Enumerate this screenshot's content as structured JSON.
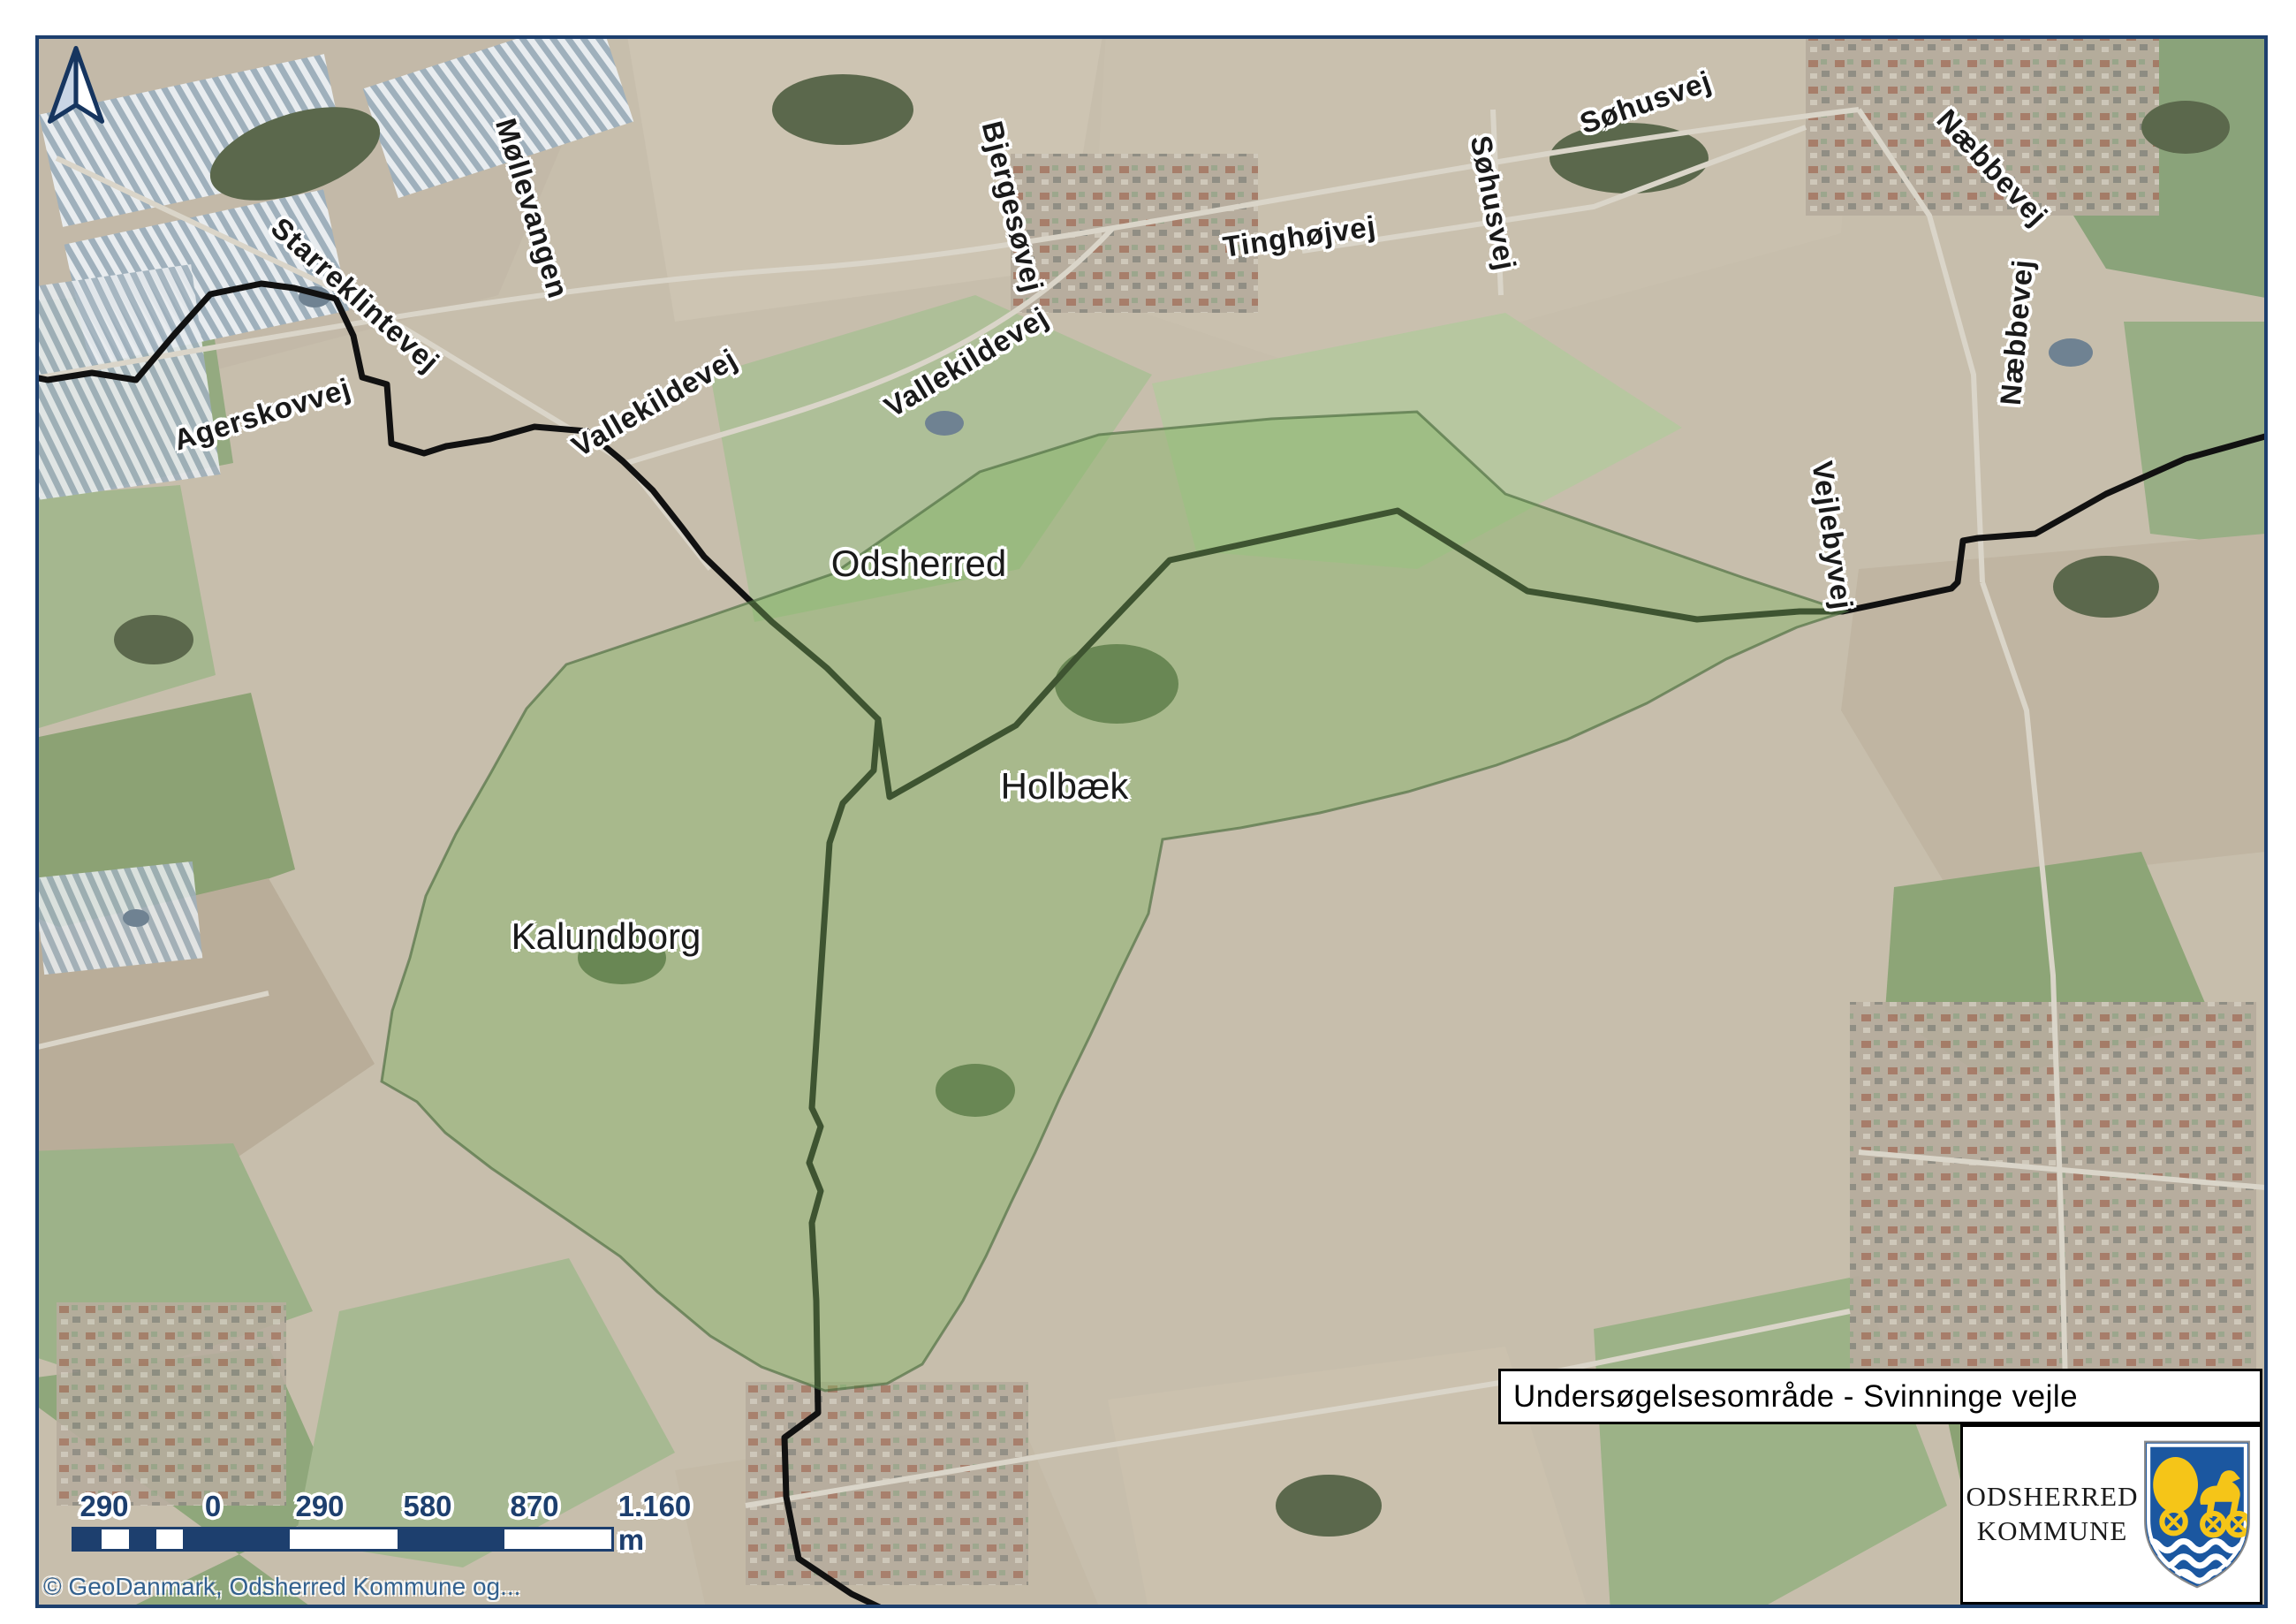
{
  "map": {
    "region_labels": [
      {
        "text": "Odsherred"
      },
      {
        "text": "Holbæk"
      },
      {
        "text": "Kalundborg"
      }
    ],
    "road_labels": [
      {
        "text": "Starreklintevej"
      },
      {
        "text": "Agerskovvej"
      },
      {
        "text": "Møllevangen"
      },
      {
        "text": "Vallekildevej"
      },
      {
        "text": "Vallekildevej"
      },
      {
        "text": "Bjergesøvej"
      },
      {
        "text": "Tinghøjvej"
      },
      {
        "text": "Søhusvej"
      },
      {
        "text": "Søhusvej"
      },
      {
        "text": "Næbbevej"
      },
      {
        "text": "Næbbevej"
      },
      {
        "text": "Vejlebyvej"
      }
    ],
    "study_area_color": "#7fb35f",
    "boundary_color": "#111111",
    "frame_color": "#1d3f6e"
  },
  "scale_bar": {
    "labels": [
      "290",
      "0",
      "290",
      "580",
      "870",
      "1.160 m"
    ]
  },
  "attribution": "© GeoDanmark, Odsherred Kommune og...",
  "title_box": {
    "title": "Undersøgelsesområde - Svinninge vejle"
  },
  "logo": {
    "name_line1": "ODSHERRED",
    "name_line2": "KOMMUNE"
  }
}
